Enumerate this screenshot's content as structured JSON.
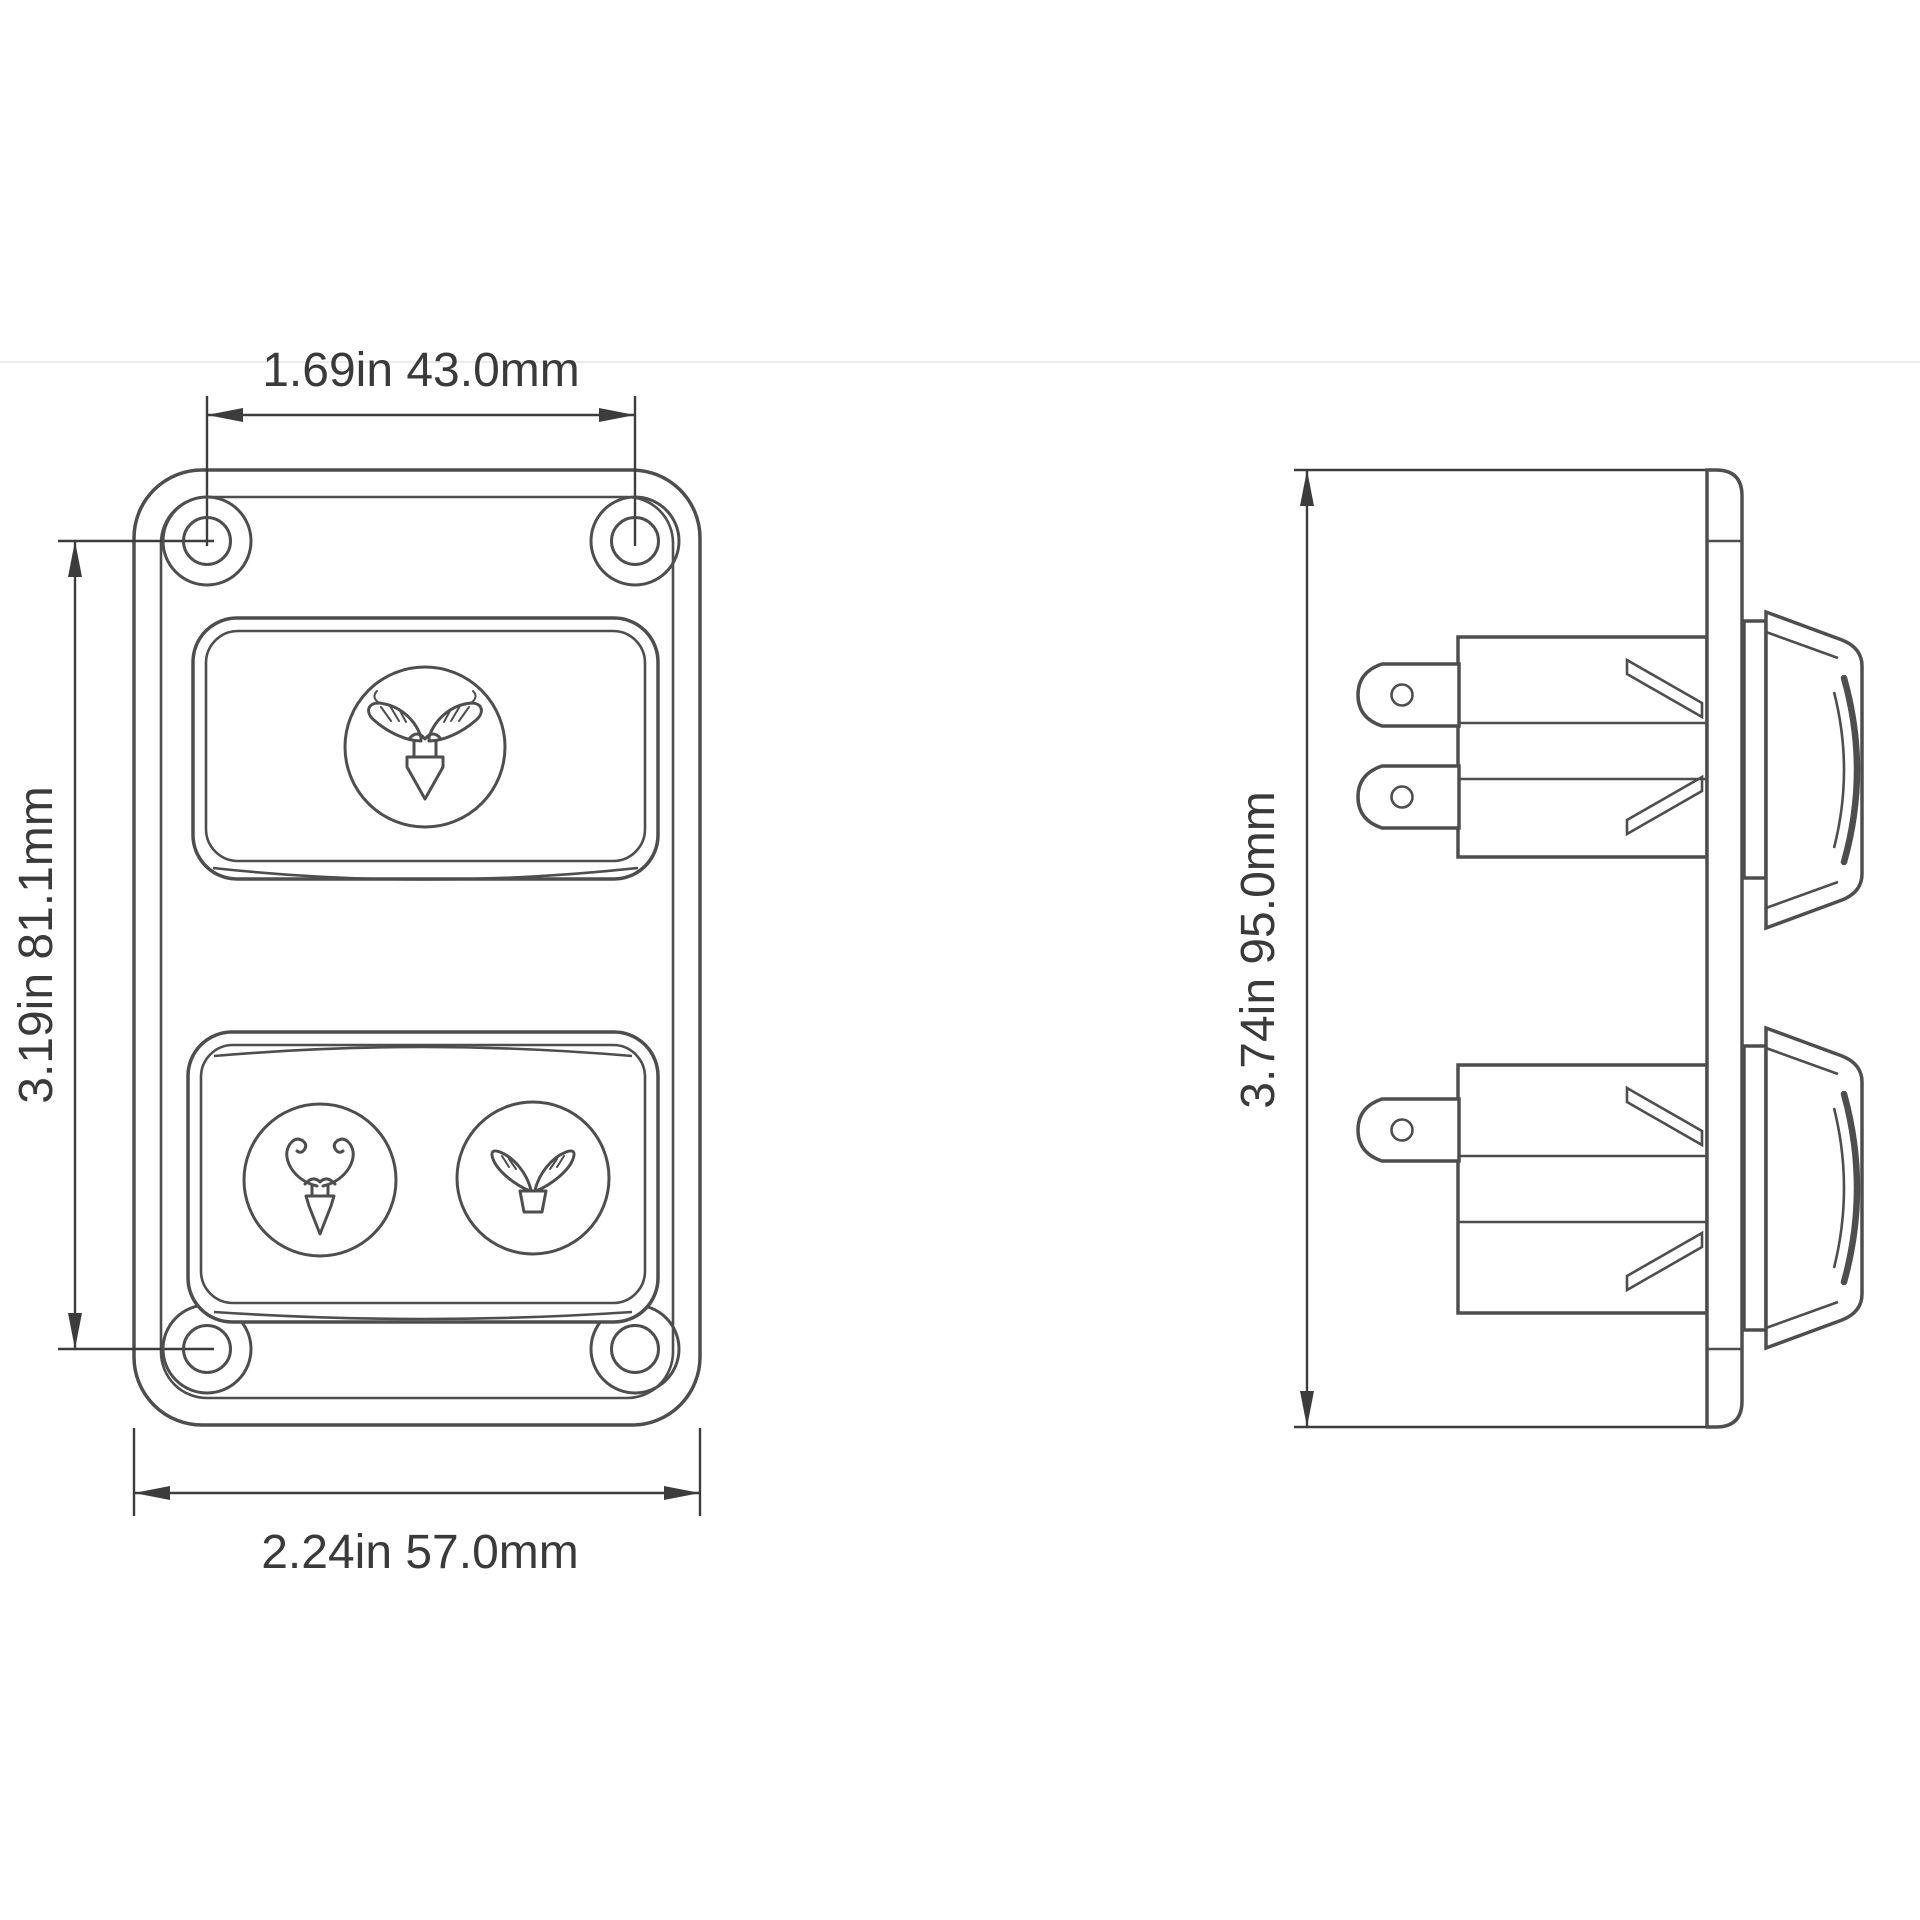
{
  "page": {
    "background": "#ffffff",
    "line_color": "#4e4e4e",
    "dim_color": "#3c3c3c",
    "text_color": "#3a3a3a",
    "divider_color": "#ececec"
  },
  "drawing": {
    "front_view": {
      "dim_hole_spacing_width": "1.69in 43.0mm",
      "dim_hole_spacing_height": "3.19in 81.1mm",
      "dim_overall_width": "2.24in 57.0mm",
      "icons": [
        "brand-wings-arrow-down-icon",
        "horns-arrow-down-icon",
        "brand-wings-icon"
      ]
    },
    "side_view": {
      "dim_overall_height": "3.74in 95.0mm"
    }
  }
}
